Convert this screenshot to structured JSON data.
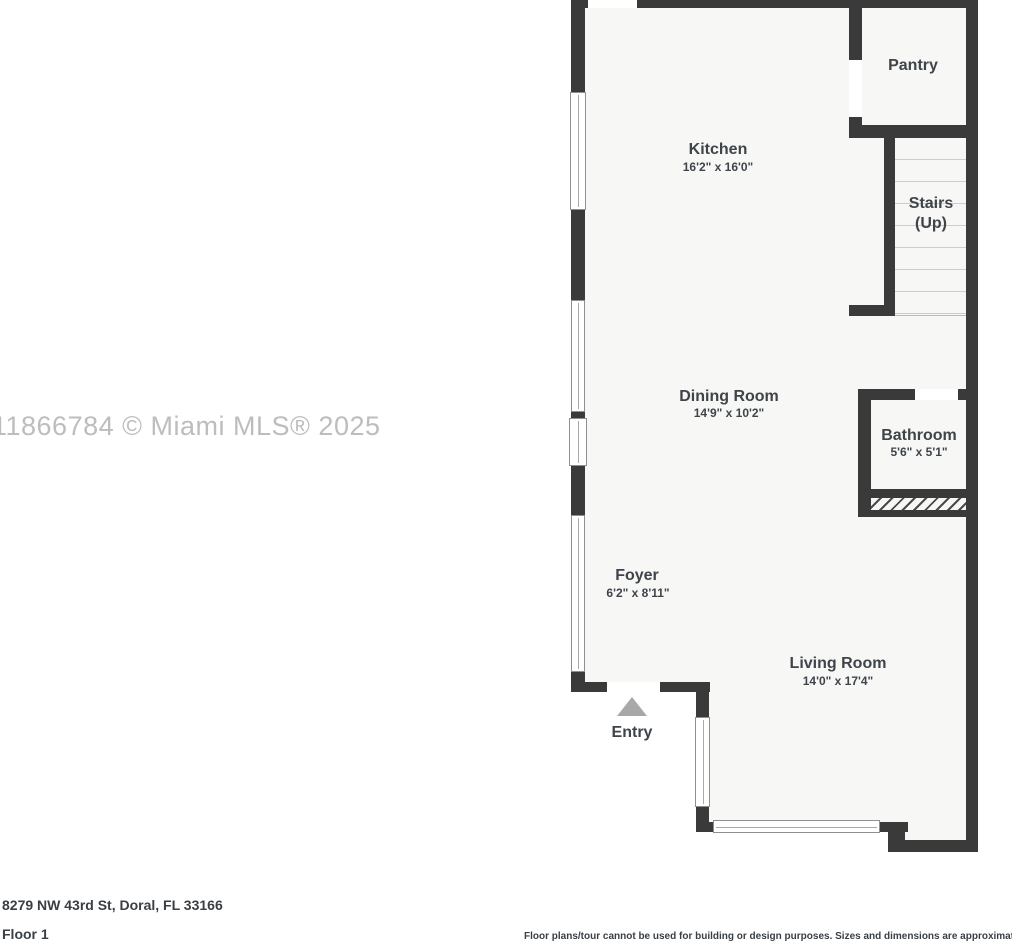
{
  "floorplan": {
    "watermark": "11866784 © Miami MLS® 2025",
    "rooms": {
      "kitchen": {
        "name": "Kitchen",
        "dims": "16'2\" x 16'0\""
      },
      "pantry": {
        "name": "Pantry"
      },
      "stairs": {
        "name": "Stairs",
        "sub": "(Up)"
      },
      "dining": {
        "name": "Dining Room",
        "dims": "14'9\" x 10'2\""
      },
      "bathroom": {
        "name": "Bathroom",
        "dims": "5'6\" x 5'1\""
      },
      "foyer": {
        "name": "Foyer",
        "dims": "6'2\" x 8'11\""
      },
      "living": {
        "name": "Living Room",
        "dims": "14'0\" x 17'4\""
      },
      "entry": {
        "name": "Entry"
      }
    },
    "footer": {
      "address": "8279 NW 43rd St, Doral, FL 33166",
      "floor_label": "Floor 1",
      "disclaimer": "Floor plans/tour cannot be used for building or design purposes. Sizes and dimensions are approximate."
    },
    "colors": {
      "wall": "#3a3a3a",
      "room_fill": "#f7f7f6",
      "label_text": "#3f444a",
      "watermark": "#bdbdbd",
      "entry_arrow": "#a8a8a8"
    }
  }
}
